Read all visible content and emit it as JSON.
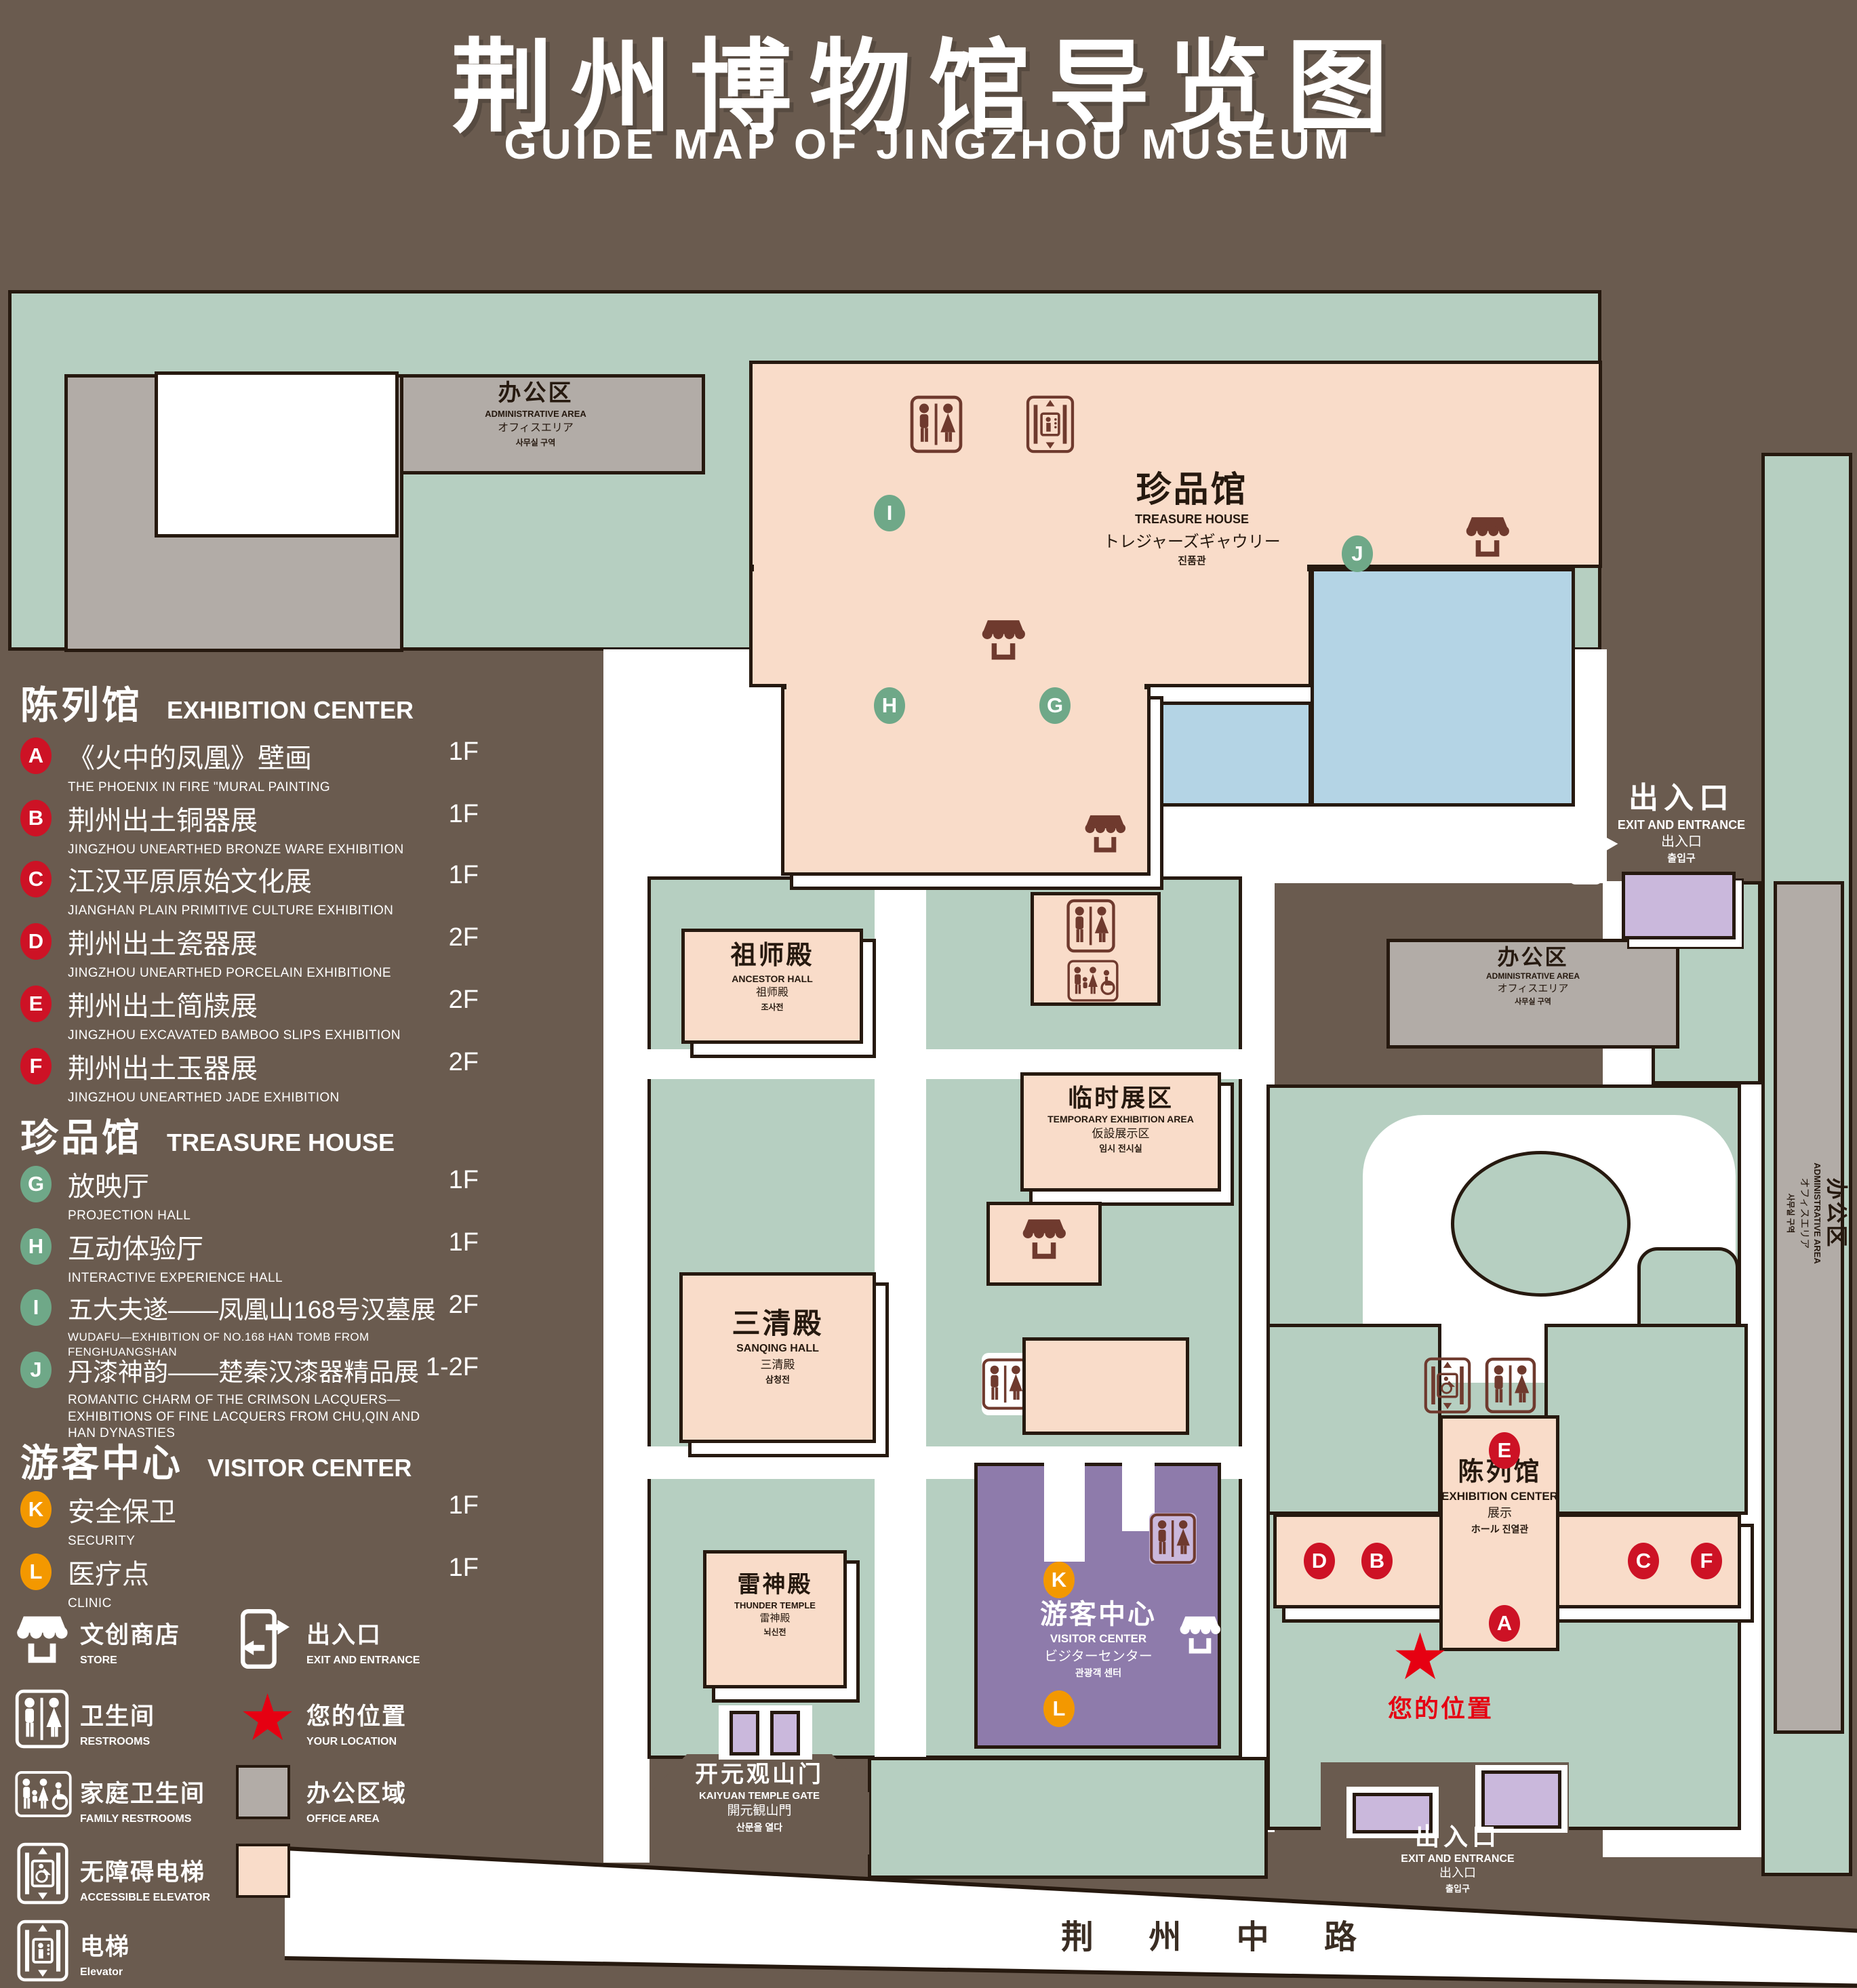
{
  "title": {
    "cn": "荆州博物馆导览图",
    "en": "GUIDE MAP OF JINGZHOU MUSEUM"
  },
  "colors": {
    "background": "#6a5b4f",
    "lawn": "#b6cfc1",
    "display_area": "#f9dcc9",
    "office_area": "#b2aca7",
    "water": "#b4d4e5",
    "visitor_center": "#8e7bab",
    "gate_building": "#cab8dc",
    "marker_exhibition": "#cd1225",
    "marker_treasure": "#6fa888",
    "marker_visitor": "#f39800",
    "your_location_red": "#e60012",
    "outline": "#26190f"
  },
  "legend": {
    "sections": [
      {
        "cn": "陈列馆",
        "en": "EXHIBITION CENTER",
        "items": [
          {
            "id": "A",
            "cn": "《火中的凤凰》壁画",
            "en": "THE PHOENIX IN FIRE \"MURAL PAINTING",
            "floor": "1F"
          },
          {
            "id": "B",
            "cn": "荆州出土铜器展",
            "en": "JINGZHOU UNEARTHED BRONZE WARE EXHIBITION",
            "floor": "1F"
          },
          {
            "id": "C",
            "cn": "江汉平原原始文化展",
            "en": "JIANGHAN PLAIN PRIMITIVE CULTURE EXHIBITION",
            "floor": "1F"
          },
          {
            "id": "D",
            "cn": "荆州出土瓷器展",
            "en": "JINGZHOU UNEARTHED PORCELAIN EXHIBITIONE",
            "floor": "2F"
          },
          {
            "id": "E",
            "cn": "荆州出土简牍展",
            "en": "JINGZHOU EXCAVATED BAMBOO SLIPS EXHIBITION",
            "floor": "2F"
          },
          {
            "id": "F",
            "cn": "荆州出土玉器展",
            "en": "JINGZHOU UNEARTHED JADE EXHIBITION",
            "floor": "2F"
          }
        ]
      },
      {
        "cn": "珍品馆",
        "en": "TREASURE HOUSE",
        "items": [
          {
            "id": "G",
            "cn": "放映厅",
            "en": "PROJECTION HALL",
            "floor": "1F"
          },
          {
            "id": "H",
            "cn": "互动体验厅",
            "en": "INTERACTIVE EXPERIENCE HALL",
            "floor": "1F"
          },
          {
            "id": "I",
            "cn": "五大夫遂——凤凰山168号汉墓展",
            "en": "WUDAFU—EXHIBITION OF NO.168 HAN TOMB FROM FENGHUANGSHAN",
            "floor": "2F"
          },
          {
            "id": "J",
            "cn": "丹漆神韵——楚秦汉漆器精品展",
            "en": "ROMANTIC CHARM OF THE CRIMSON LACQUERS—EXHIBITIONS OF FINE LACQUERS FROM CHU,QIN AND HAN DYNASTIES",
            "floor": "1-2F"
          }
        ]
      },
      {
        "cn": "游客中心",
        "en": "VISITOR CENTER",
        "items": [
          {
            "id": "K",
            "cn": "安全保卫",
            "en": "SECURITY",
            "floor": "1F"
          },
          {
            "id": "L",
            "cn": "医疗点",
            "en": "CLINIC",
            "floor": "1F"
          }
        ]
      }
    ],
    "symbols": [
      {
        "icon": "store-icon",
        "cn": "文创商店",
        "en": "STORE"
      },
      {
        "icon": "exit-icon",
        "cn": "出入口",
        "en": "EXIT AND ENTRANCE"
      },
      {
        "icon": "restroom-icon",
        "cn": "卫生间",
        "en": "RESTROOMS"
      },
      {
        "icon": "location-star-icon",
        "cn": "您的位置",
        "en": "YOUR LOCATION"
      },
      {
        "icon": "family-restroom-icon",
        "cn": "家庭卫生间",
        "en": "FAMILY RESTROOMS"
      },
      {
        "icon": "office-area-swatch",
        "cn": "办公区域",
        "en": "OFFICE AREA"
      },
      {
        "icon": "accessible-elevator-icon",
        "cn": "无障碍电梯",
        "en": "ACCESSIBLE ELEVATOR"
      },
      {
        "icon": "display-area-swatch",
        "cn": "展示区域",
        "en": "DISPLAY AREA"
      },
      {
        "icon": "elevator-icon",
        "cn": "电梯",
        "en": "Elevator"
      }
    ]
  },
  "map": {
    "admin": {
      "cn": "办公区",
      "en": "ADMINISTRATIVE AREA",
      "jp": "オフィスエリア",
      "kr": "사무실 구역"
    },
    "treasure": {
      "cn": "珍品馆",
      "en": "TREASURE HOUSE",
      "jp": "トレジャーズギャウリー",
      "kr": "진품관"
    },
    "ancestor": {
      "cn": "祖师殿",
      "en": "ANCESTOR HALL",
      "jp": "祖师殿",
      "kr": "조사전"
    },
    "temporary": {
      "cn": "临时展区",
      "en": "TEMPORARY EXHIBITION AREA",
      "jp": "仮設展示区",
      "kr": "임시 전시실"
    },
    "sanqing": {
      "cn": "三清殿",
      "en": "SANQING HALL",
      "jp": "三清殿",
      "kr": "삼청전"
    },
    "thunder": {
      "cn": "雷神殿",
      "en": "THUNDER TEMPLE",
      "jp": "雷神殿",
      "kr": "뇌신전"
    },
    "visitor": {
      "cn": "游客中心",
      "en": "VISITOR CENTER",
      "jp": "ビジターセンター",
      "kr": "관광객 센터"
    },
    "exhibition": {
      "cn": "陈列馆",
      "en": "EXHIBITION CENTER",
      "jp": "展示",
      "kr": "ホール 진열관"
    },
    "gate": {
      "cn": "开元观山门",
      "en": "KAIYUAN TEMPLE GATE",
      "jp": "開元観山門",
      "kr": "산문을 열다"
    },
    "exit": {
      "cn": "出入口",
      "en": "EXIT AND ENTRANCE",
      "jp": "出入口",
      "kr": "출입구"
    },
    "your_location": "您的位置",
    "road": "荆 州 中 路"
  }
}
